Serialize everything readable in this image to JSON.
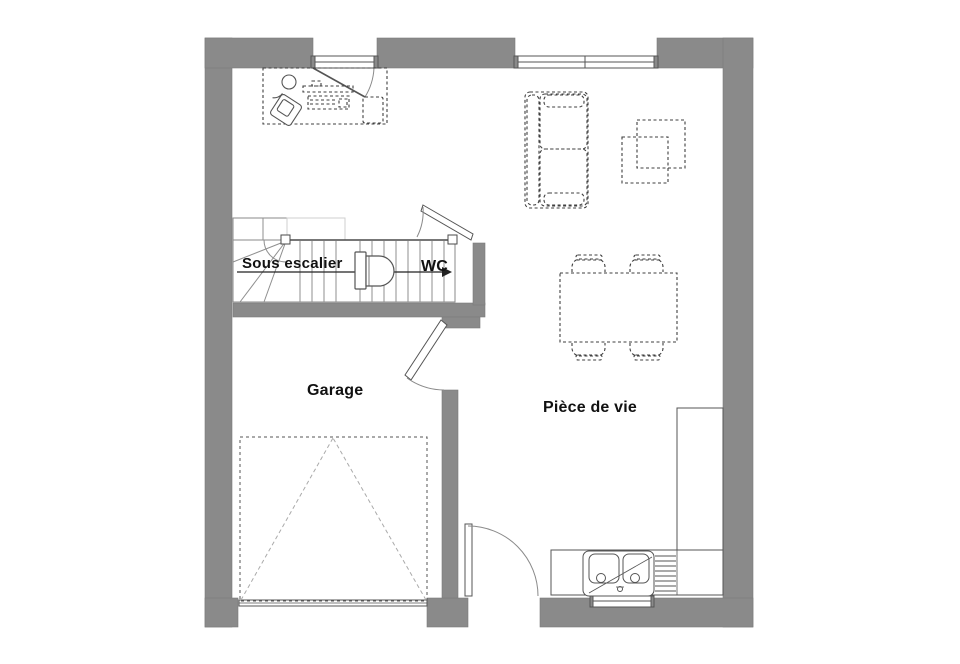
{
  "plan": {
    "title": "floor-plan-ground-floor",
    "labels": {
      "sous_escalier": "Sous escalier",
      "wc": "WC",
      "garage": "Garage",
      "piece_de_vie": "Pièce de vie"
    },
    "colors": {
      "wall": "#8a8a8a",
      "outline": "#555555",
      "furniture": "#3f3f3f",
      "light": "#c9c9c9",
      "background": "#ffffff"
    },
    "rooms": [
      {
        "name": "office-area"
      },
      {
        "name": "sous-escalier-storage"
      },
      {
        "name": "wc"
      },
      {
        "name": "garage"
      },
      {
        "name": "piece-de-vie"
      }
    ],
    "fixtures": [
      {
        "name": "desk-with-computer"
      },
      {
        "name": "office-chair"
      },
      {
        "name": "staircase-with-winder"
      },
      {
        "name": "toilet"
      },
      {
        "name": "sofa"
      },
      {
        "name": "coffee-tables"
      },
      {
        "name": "dining-table-4-chairs"
      },
      {
        "name": "kitchen-counter"
      },
      {
        "name": "double-sink"
      },
      {
        "name": "tall-cabinet"
      },
      {
        "name": "car-parking-space"
      },
      {
        "name": "garage-sectional-door"
      },
      {
        "name": "entry-door"
      },
      {
        "name": "french-window"
      },
      {
        "name": "bay-window"
      },
      {
        "name": "kitchen-window"
      }
    ]
  }
}
